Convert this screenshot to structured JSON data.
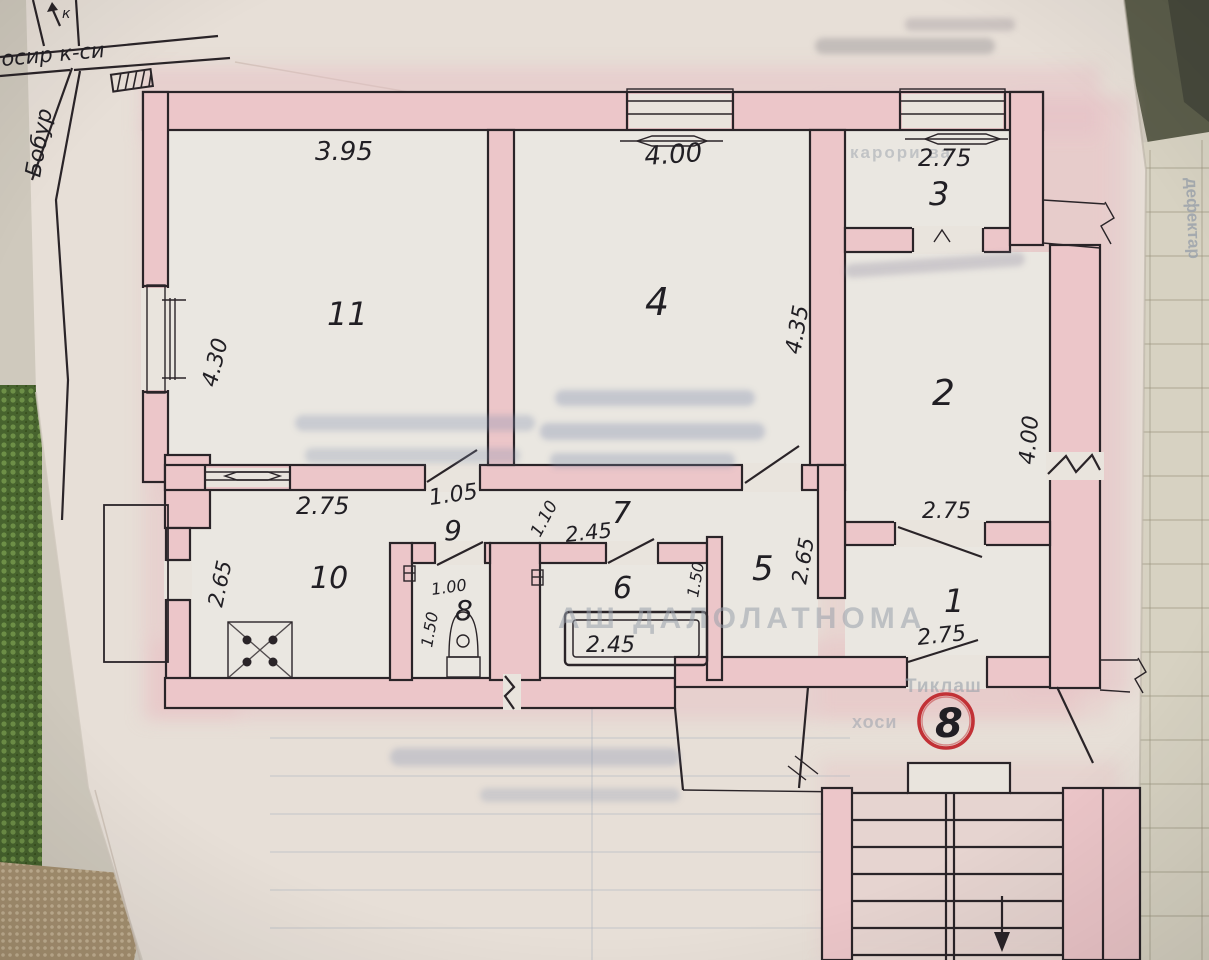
{
  "location_sketch": {
    "street_horizontal": "осир к-си",
    "street_vertical": "Бобур",
    "compass_letter": "к"
  },
  "room_labels": {
    "r1": "1",
    "r2": "2",
    "r3": "3",
    "r4": "4",
    "r5": "5",
    "r6": "6",
    "r7": "7",
    "r8": "8",
    "r9": "9",
    "r10": "10",
    "r11": "11"
  },
  "dimensions": {
    "room11_top": "3.95",
    "room11_left": "4.30",
    "room4_top": "4.00",
    "room4_right": "4.35",
    "room3_top": "2.75",
    "room2_right": "4.00",
    "room2_bottom": "2.75",
    "lobby9_door": "1.05",
    "hall7_width": "1.10",
    "hall7_length": "2.45",
    "kitchen10_top": "2.75",
    "kitchen10_left": "2.65",
    "wc8_door": "1.00",
    "wc8_width": "1.50",
    "bath6_right": "1.50",
    "bath6_tub": "2.45",
    "hall5_wall": "2.65",
    "room1_door": "2.75"
  },
  "apartment_number_circled": "8",
  "faint_print_fragments": {
    "top_right": "карори ва",
    "title": "АШ ДАЛОЛАТНОМА",
    "form_word_1": "Тиклаш",
    "form_word_2": "хоси",
    "side_page_rotated": "дефектар"
  },
  "accent_colors": {
    "wall_highlight": "#ecc6c9",
    "circle_red": "#c23136",
    "ink": "#2a2428"
  }
}
